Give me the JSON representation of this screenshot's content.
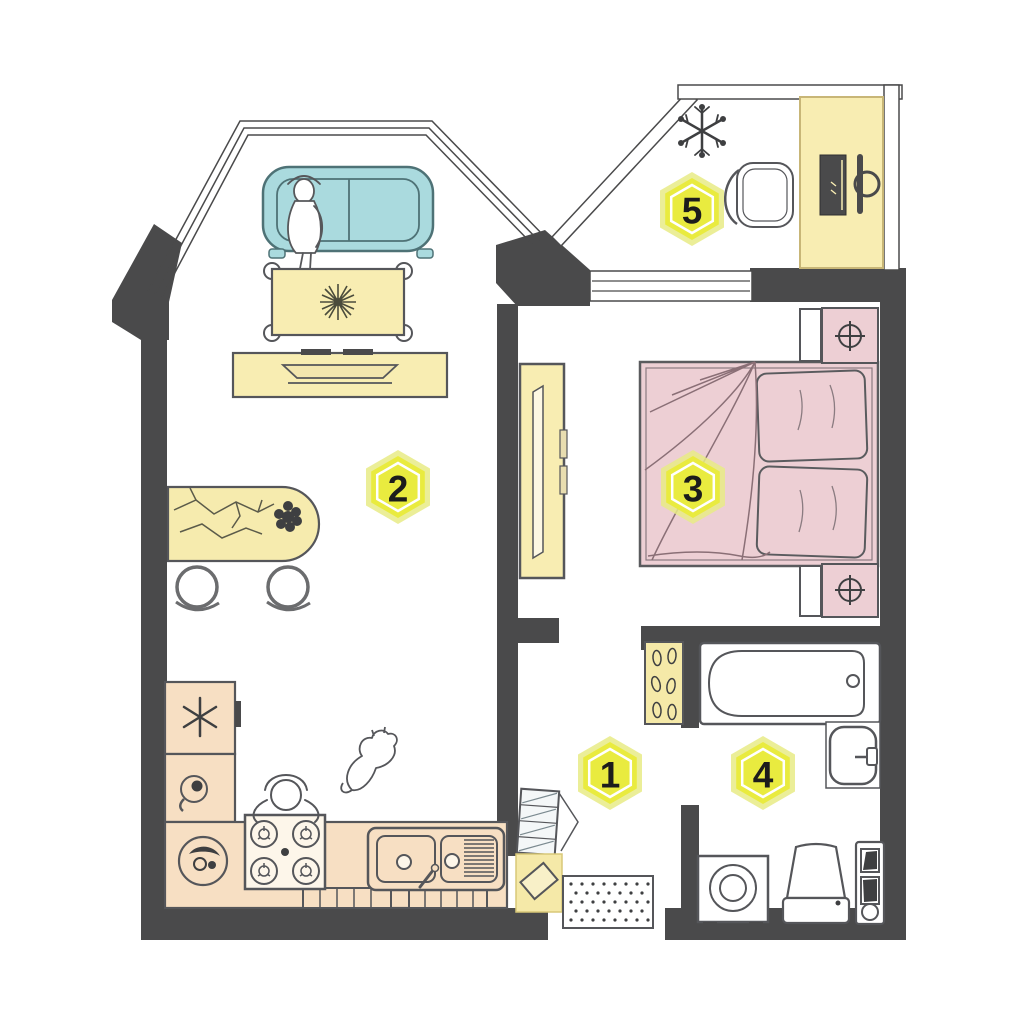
{
  "plan": {
    "badges": [
      {
        "id": "room-1",
        "number": "1"
      },
      {
        "id": "room-2",
        "number": "2"
      },
      {
        "id": "room-3",
        "number": "3"
      },
      {
        "id": "room-4",
        "number": "4"
      },
      {
        "id": "room-5",
        "number": "5"
      }
    ],
    "colors": {
      "walls": "#4a4a4b",
      "outline": "#55565a",
      "furniture_yellow": "#f8edb2",
      "accent_yellow": "#f5e9a8",
      "kitchen_peach": "#f7dfc3",
      "bed_pink": "#edcfd4",
      "sofa_teal": "#aadade",
      "badge_yellow": "#e9eb3f",
      "badge_halo": "#e7eb86",
      "badge_number": "#1c1c1c",
      "floor": "#ffffff"
    }
  }
}
